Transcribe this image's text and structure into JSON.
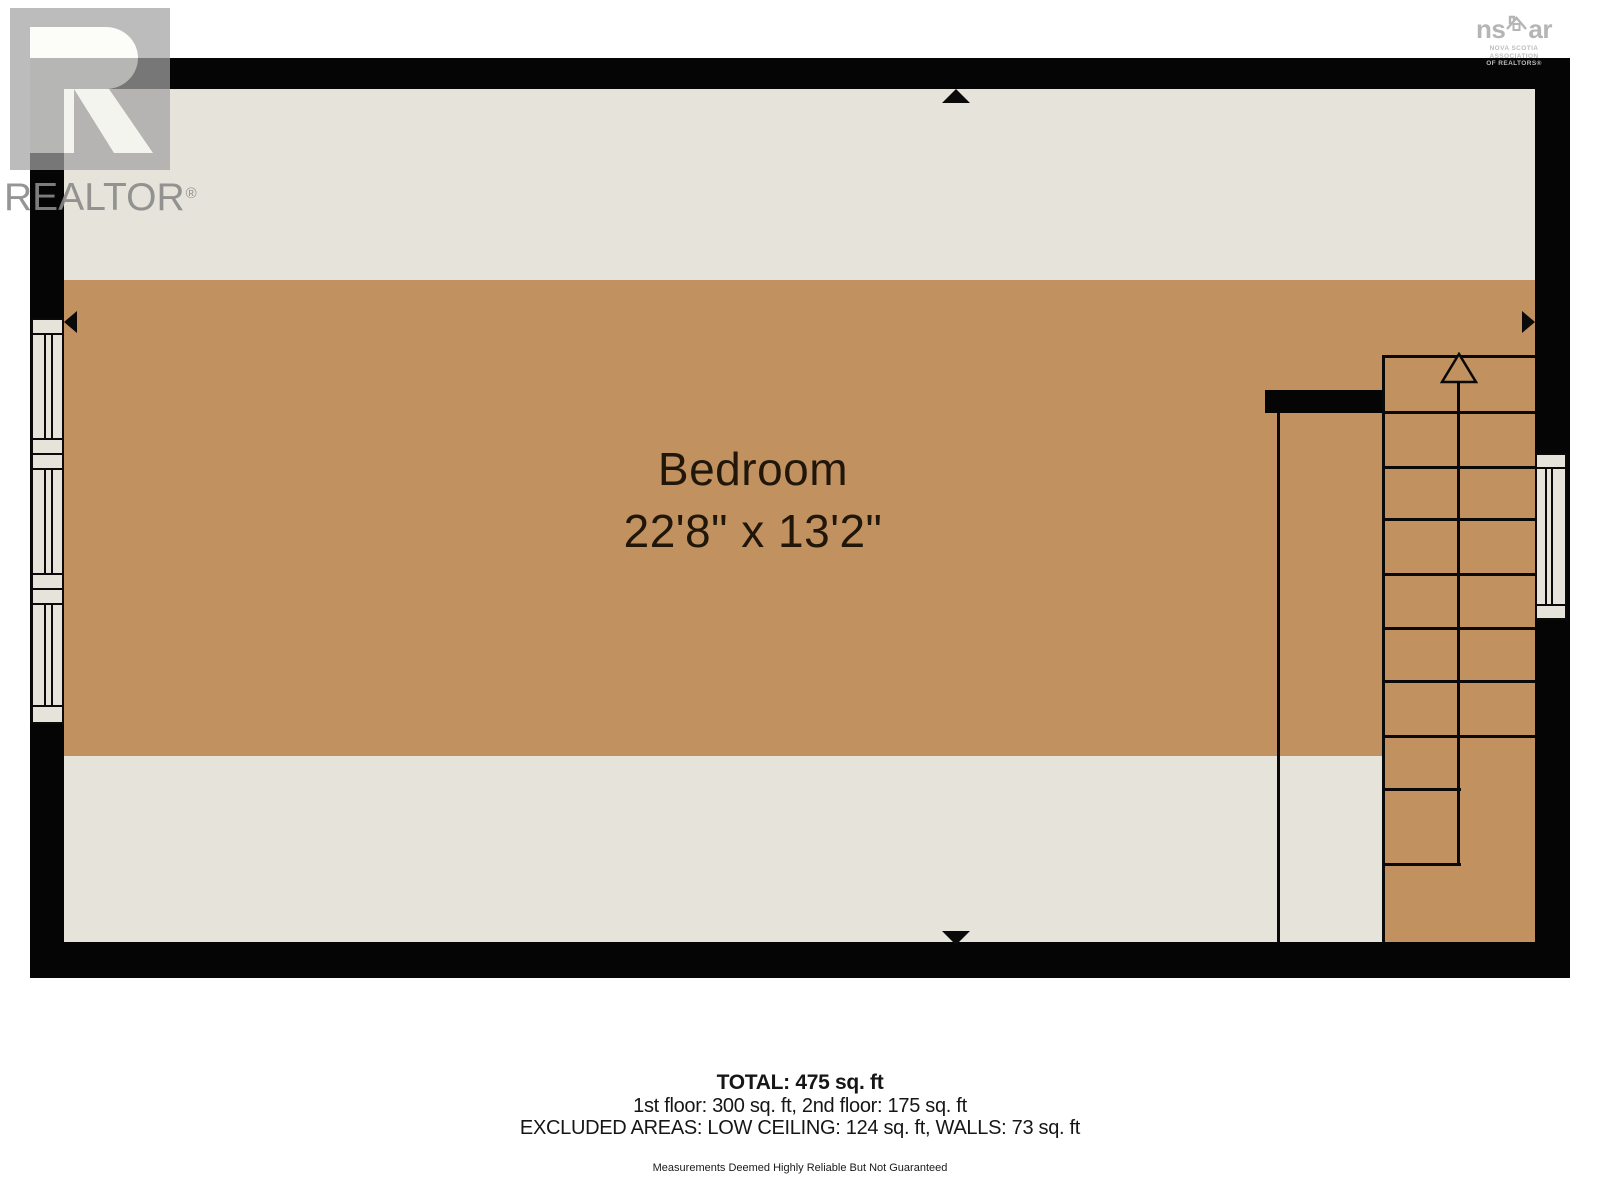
{
  "branding": {
    "realtor": {
      "wordmark": "REALTOR",
      "registered": "®"
    },
    "nsar": {
      "word_left": "ns",
      "word_right": "ar",
      "caption1": "NOVA SCOTIA ASSOCIATION",
      "caption2": "OF REALTORS®"
    }
  },
  "plan": {
    "room_name": "Bedroom",
    "room_dimensions": "22'8\" x 13'2\"",
    "stairs_direction": "up",
    "colors": {
      "floor_main": "#c19160",
      "floor_low_ceiling": "#e5e3da",
      "wall": "#050505",
      "window_fill": "#e5e3da"
    }
  },
  "summary": {
    "total": "TOTAL: 475 sq. ft",
    "floors": "1st floor: 300 sq. ft, 2nd floor: 175 sq. ft",
    "excluded": "EXCLUDED AREAS: LOW CEILING: 124 sq. ft, WALLS: 73 sq. ft",
    "disclaimer": "Measurements Deemed Highly Reliable But Not Guaranteed"
  }
}
